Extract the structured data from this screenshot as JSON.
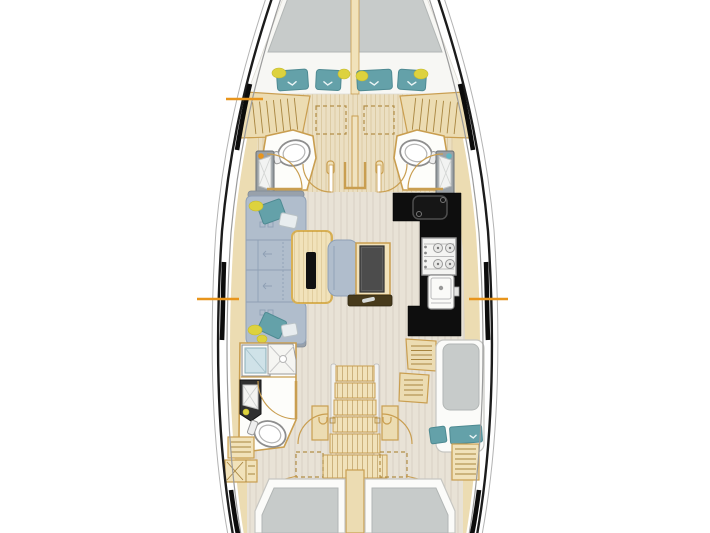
{
  "meta": {
    "title": "Sailing yacht interior layout — top-down floor plan drawing, no visible text labels"
  },
  "colors": {
    "hull": "#1c1c1c",
    "hull-secondary": "#9b9b9b",
    "wood": "#ecdcb2",
    "wood-light": "#f1e2ba",
    "floor": "#e8e2d6",
    "floor-forward": "#ebdfc2",
    "wall": "#c99e50",
    "mattress": "#c7cbca",
    "pillow": "#64a1a9",
    "sofa": "#b0bdcc",
    "sofa-line": "#8fa0b5",
    "counter": "#0e0e0e",
    "cabinet-dark": "#303030",
    "shower-bench": "#cfe2e8",
    "tray": "#473a1b",
    "accent-orange": "#e8951c",
    "accent-yellow": "#ddd23e"
  },
  "legend": {
    "rooms": [
      {
        "id": "owners-cabin-forward",
        "name": "forward cabin with V-berth and four teal pillows"
      },
      {
        "id": "head-forward-port",
        "name": "port forward head with toilet and washbasin"
      },
      {
        "id": "head-forward-starboard",
        "name": "starboard forward head with toilet and washbasin"
      },
      {
        "id": "salon",
        "name": "salon with U-shaped sofa, folding table, nav seat and chart table"
      },
      {
        "id": "galley",
        "name": "galley with black worktop, sink, two-burner stove and second sink"
      },
      {
        "id": "head-aft-port",
        "name": "aft port head with shower stall, washbasin and toilet"
      },
      {
        "id": "companionway",
        "name": "companionway stairs"
      },
      {
        "id": "cabin-aft-starboard",
        "name": "aft starboard cabin with single berth"
      },
      {
        "id": "aft-berths",
        "name": "two aft double berths at stern"
      }
    ]
  },
  "markers": {
    "section_lines": [
      {
        "side": "port",
        "y": 99
      },
      {
        "side": "port",
        "y": 299
      },
      {
        "side": "starboard",
        "y": 299
      }
    ]
  }
}
